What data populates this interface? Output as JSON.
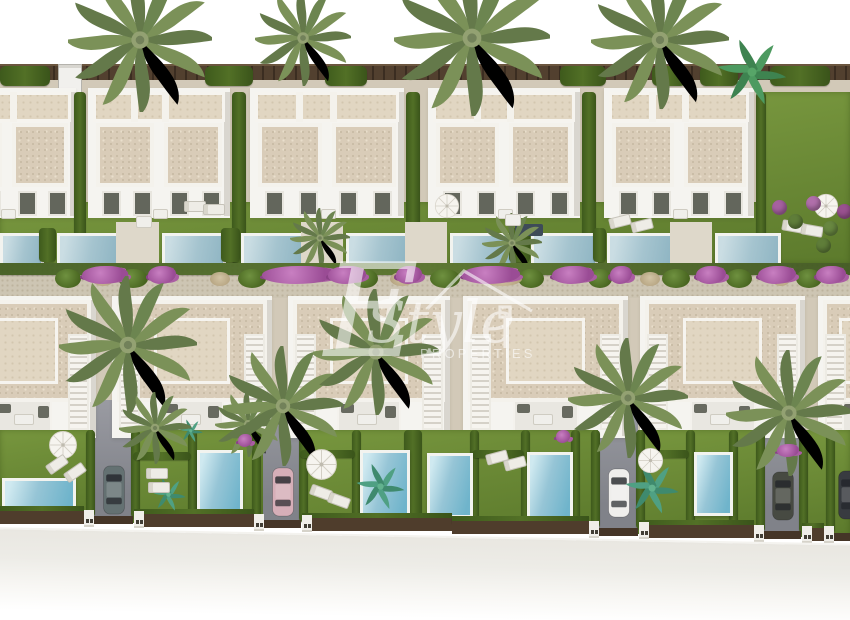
{
  "watermark": {
    "letter": "E",
    "script": "Style",
    "caption": "PROPERTIES",
    "icon": "house-roof-icon",
    "color": "#ffffff",
    "opacity": 0.58
  },
  "palette": {
    "sky": "#ffffff",
    "wall": "#f5f4f0",
    "roof": "#d9ccb8",
    "roof_upper": "#e1d6c2",
    "grass": "#6d8c34",
    "hedge": "#46611f",
    "pool_water": "#7fc3d9",
    "pool_rim": "#f2f3ef",
    "gravel_path": "#cdc5b3",
    "street": "#e8e6e0",
    "fence": "#4c3b2b",
    "driveway": "#8e9096",
    "bougainvillea": "#a85ca4",
    "palm": "#7b9158",
    "watermark": "#ffffff"
  },
  "scene": {
    "palms_top": [
      {
        "x": 140,
        "y": 40,
        "s": 1.2
      },
      {
        "x": 303,
        "y": 38,
        "s": 0.8
      },
      {
        "x": 472,
        "y": 38,
        "s": 1.3
      },
      {
        "x": 660,
        "y": 40,
        "s": 1.15
      },
      {
        "x": 752,
        "y": 72,
        "s": 0.75,
        "kind": "banana"
      }
    ],
    "fence": {
      "y": 64,
      "h": 14
    },
    "gravel": {
      "y": 76,
      "h": 130
    },
    "fence_hedges": [
      {
        "x": 0,
        "w": 50
      },
      {
        "x": 205,
        "w": 48
      },
      {
        "x": 325,
        "w": 42
      },
      {
        "x": 560,
        "w": 46
      },
      {
        "x": 652,
        "w": 34
      },
      {
        "x": 700,
        "w": 38
      },
      {
        "x": 770,
        "w": 60
      }
    ],
    "van": {
      "x": 58,
      "y": 64,
      "w": 22,
      "h": 28
    },
    "top_grass": {
      "x": 0,
      "y": 202,
      "w": 764,
      "h": 62
    },
    "corner_garden": {
      "x": 762,
      "y": 92,
      "w": 88,
      "h": 172
    },
    "top_blocks": [
      {
        "x": -62,
        "w": 138
      },
      {
        "x": 88,
        "w": 142
      },
      {
        "x": 250,
        "w": 154
      },
      {
        "x": 428,
        "w": 152
      },
      {
        "x": 604,
        "w": 150
      }
    ],
    "top_hedges": [
      {
        "x": 74,
        "w": 12
      },
      {
        "x": 232,
        "w": 14
      },
      {
        "x": 406,
        "w": 14
      },
      {
        "x": 582,
        "w": 14
      },
      {
        "x": 756,
        "w": 10
      }
    ],
    "top_pools": [
      {
        "x": 0,
        "w": 38
      },
      {
        "x": 57,
        "w": 56
      },
      {
        "x": 162,
        "w": 58
      },
      {
        "x": 241,
        "w": 57
      },
      {
        "x": 346,
        "w": 56
      },
      {
        "x": 450,
        "w": 58
      },
      {
        "x": 531,
        "w": 61
      },
      {
        "x": 607,
        "w": 60
      },
      {
        "x": 715,
        "w": 60
      }
    ],
    "top_pool_y": 233,
    "top_pool_h": 29,
    "top_props": {
      "parasols": [
        {
          "x": 447,
          "y": 206
        },
        {
          "x": 826,
          "y": 206
        }
      ],
      "loungers": [
        {
          "x": 609,
          "y": 216,
          "r": -14
        },
        {
          "x": 631,
          "y": 220,
          "r": -14
        },
        {
          "x": 782,
          "y": 221,
          "r": 10
        },
        {
          "x": 801,
          "y": 225,
          "r": 10
        },
        {
          "x": 184,
          "y": 201,
          "r": 0
        },
        {
          "x": 203,
          "y": 204,
          "r": 0
        }
      ],
      "tables": [
        {
          "x": 136,
          "y": 216
        },
        {
          "x": 505,
          "y": 214
        }
      ],
      "pergolas": [
        {
          "x": 515,
          "y": 224,
          "w": 28,
          "h": 12
        }
      ],
      "palms": [
        {
          "x": 512,
          "y": 243,
          "s": 0.5
        },
        {
          "x": 320,
          "y": 238,
          "s": 0.5
        }
      ],
      "plants": [
        {
          "x": 772,
          "y": 200,
          "c": "#a661a0"
        },
        {
          "x": 788,
          "y": 214,
          "c": "#5f7d39"
        },
        {
          "x": 806,
          "y": 196,
          "c": "#b06faa"
        },
        {
          "x": 823,
          "y": 221,
          "c": "#688740"
        },
        {
          "x": 837,
          "y": 204,
          "c": "#99518f"
        },
        {
          "x": 816,
          "y": 238,
          "c": "#5f7d39"
        }
      ]
    },
    "strip": {
      "y": 263,
      "h": 37
    },
    "strip_hedge": {
      "y": 263,
      "h": 12
    },
    "strip_bushes": [
      {
        "x": 55,
        "w": 26
      },
      {
        "x": 118,
        "w": 30
      },
      {
        "x": 238,
        "w": 28
      },
      {
        "x": 352,
        "w": 26
      },
      {
        "x": 430,
        "w": 30
      },
      {
        "x": 518,
        "w": 26
      },
      {
        "x": 588,
        "w": 24
      },
      {
        "x": 662,
        "w": 28
      },
      {
        "x": 726,
        "w": 26
      },
      {
        "x": 796,
        "w": 26
      }
    ],
    "strip_dry": [
      {
        "x": 92,
        "w": 22
      },
      {
        "x": 210,
        "w": 20
      },
      {
        "x": 390,
        "w": 24
      },
      {
        "x": 482,
        "w": 40
      },
      {
        "x": 640,
        "w": 20
      },
      {
        "x": 772,
        "w": 18
      }
    ],
    "strip_flowers": [
      {
        "x": 82,
        "w": 46
      },
      {
        "x": 148,
        "w": 28
      },
      {
        "x": 262,
        "w": 74
      },
      {
        "x": 328,
        "w": 38
      },
      {
        "x": 396,
        "w": 26
      },
      {
        "x": 462,
        "w": 58
      },
      {
        "x": 552,
        "w": 42
      },
      {
        "x": 610,
        "w": 22
      },
      {
        "x": 696,
        "w": 30
      },
      {
        "x": 758,
        "w": 38
      },
      {
        "x": 816,
        "w": 30
      }
    ],
    "bottom_gravel": {
      "y": 298,
      "h": 134
    },
    "bottom_blocks": [
      {
        "x": -50,
        "w": 146
      },
      {
        "x": 112,
        "w": 160
      },
      {
        "x": 288,
        "w": 162
      },
      {
        "x": 463,
        "w": 165
      },
      {
        "x": 640,
        "w": 165
      },
      {
        "x": 818,
        "w": 80
      }
    ],
    "driveways": [
      {
        "x": 93,
        "w": 40
      },
      {
        "x": 263,
        "w": 38
      },
      {
        "x": 598,
        "w": 40
      },
      {
        "x": 763,
        "w": 38
      },
      {
        "x": 833,
        "w": 17
      }
    ],
    "bottom_grass": [
      {
        "x": 0,
        "w": 93
      },
      {
        "x": 133,
        "w": 130
      },
      {
        "x": 303,
        "w": 295
      },
      {
        "x": 638,
        "w": 125
      },
      {
        "x": 801,
        "w": 49
      }
    ],
    "bottom_hedges_v": [
      {
        "x": 86
      },
      {
        "x": 131
      },
      {
        "x": 188
      },
      {
        "x": 252
      },
      {
        "x": 299
      },
      {
        "x": 352
      },
      {
        "x": 404,
        "w": 18
      },
      {
        "x": 470
      },
      {
        "x": 521
      },
      {
        "x": 571
      },
      {
        "x": 591
      },
      {
        "x": 636
      },
      {
        "x": 686
      },
      {
        "x": 729
      },
      {
        "x": 756
      },
      {
        "x": 799
      },
      {
        "x": 826
      }
    ],
    "bottom_hedges_h": [
      {
        "x": 133,
        "y": 452,
        "w": 58
      },
      {
        "x": 300,
        "y": 450,
        "w": 55
      },
      {
        "x": 472,
        "y": 450,
        "w": 52
      },
      {
        "x": 641,
        "y": 450,
        "w": 48
      }
    ],
    "bottom_pools": [
      {
        "x": 2,
        "y": 478,
        "w": 68,
        "h": 34
      },
      {
        "x": 197,
        "y": 450,
        "w": 40,
        "h": 66
      },
      {
        "x": 360,
        "y": 450,
        "w": 44,
        "h": 66
      },
      {
        "x": 427,
        "y": 453,
        "w": 40,
        "h": 59
      },
      {
        "x": 527,
        "y": 452,
        "w": 40,
        "h": 65
      },
      {
        "x": 694,
        "y": 452,
        "w": 33,
        "h": 58
      },
      {
        "x": 843,
        "y": 476,
        "w": 7,
        "h": 30
      }
    ],
    "cars": [
      {
        "x": 101,
        "y": 464,
        "c": "#647172"
      },
      {
        "x": 270,
        "y": 466,
        "c": "#d6aeb8"
      },
      {
        "x": 606,
        "y": 467,
        "c": "#efeeec"
      },
      {
        "x": 770,
        "y": 470,
        "c": "#474a42"
      },
      {
        "x": 836,
        "y": 469,
        "c": "#383b40"
      }
    ],
    "palms_bottom": [
      {
        "x": 128,
        "y": 345,
        "s": 1.15
      },
      {
        "x": 155,
        "y": 428,
        "s": 0.6
      },
      {
        "x": 248,
        "y": 424,
        "s": 0.55
      },
      {
        "x": 283,
        "y": 406,
        "s": 1.0
      },
      {
        "x": 376,
        "y": 352,
        "s": 1.05
      },
      {
        "x": 628,
        "y": 398,
        "s": 1.0
      },
      {
        "x": 789,
        "y": 413,
        "s": 1.05
      }
    ],
    "parasols_bottom": [
      {
        "x": 63,
        "y": 445,
        "s": 30
      },
      {
        "x": 321,
        "y": 464,
        "s": 33
      },
      {
        "x": 650,
        "y": 460,
        "s": 27
      }
    ],
    "loungers_bottom": [
      {
        "x": 46,
        "y": 459,
        "r": -35
      },
      {
        "x": 64,
        "y": 467,
        "r": -35
      },
      {
        "x": 146,
        "y": 468,
        "r": 0
      },
      {
        "x": 148,
        "y": 482,
        "r": 0
      },
      {
        "x": 310,
        "y": 487,
        "r": 20
      },
      {
        "x": 328,
        "y": 495,
        "r": 20
      },
      {
        "x": 486,
        "y": 452,
        "r": -15
      },
      {
        "x": 504,
        "y": 458,
        "r": -15
      }
    ],
    "plants_bottom": [
      {
        "x": 168,
        "y": 494,
        "s": 0.5
      },
      {
        "x": 380,
        "y": 486,
        "s": 0.7
      },
      {
        "x": 652,
        "y": 488,
        "s": 0.78
      },
      {
        "x": 191,
        "y": 431,
        "s": 0.35
      }
    ],
    "purple_bottom": [
      {
        "x": 777,
        "y": 444,
        "w": 22
      },
      {
        "x": 238,
        "y": 434,
        "w": 14
      },
      {
        "x": 556,
        "y": 430,
        "w": 14
      }
    ],
    "walls_front": [
      {
        "x": 0,
        "w": 84
      },
      {
        "x": 134,
        "w": 120
      },
      {
        "x": 302,
        "w": 150
      },
      {
        "x": 452,
        "w": 137
      },
      {
        "x": 639,
        "w": 115
      },
      {
        "x": 802,
        "w": 22
      }
    ],
    "street": {
      "y": 529,
      "h": 95
    }
  }
}
